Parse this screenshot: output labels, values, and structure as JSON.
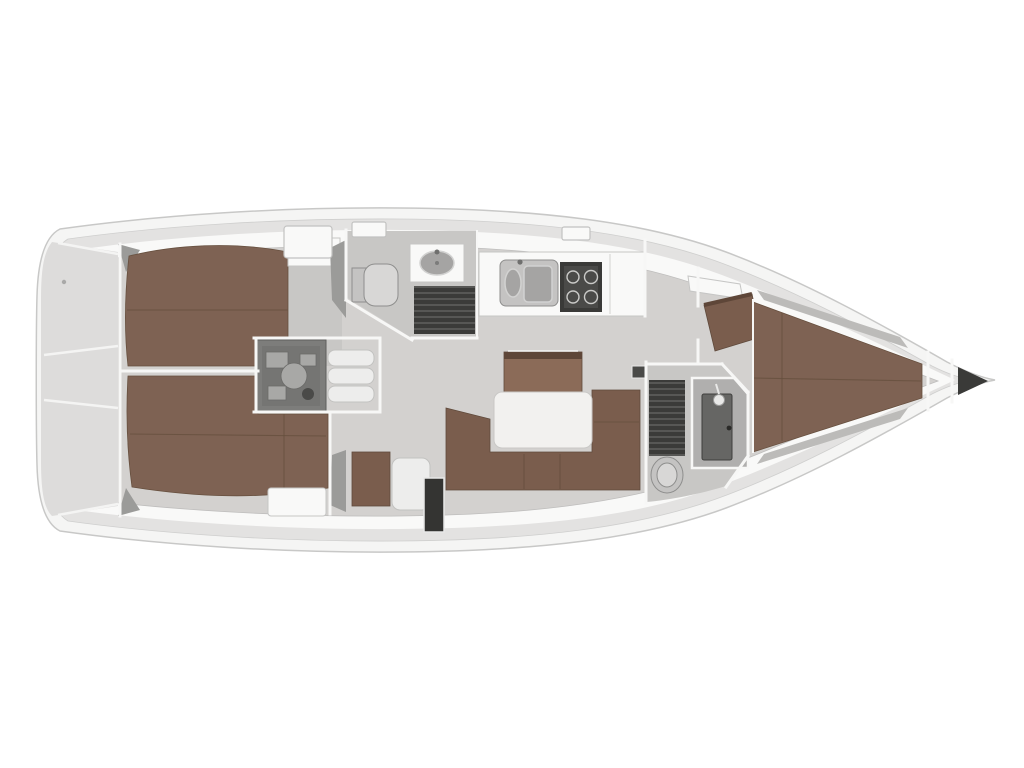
{
  "image": {
    "kind": "sailing-yacht-interior-floor-plan",
    "view": "top-down",
    "orientation": "bow-right-stern-left",
    "visible_text": ""
  },
  "colors": {
    "background": "#ffffff",
    "hull_white": "#f5f5f4",
    "hull_stroke": "#c8c8c7",
    "lining_gray": "#e3e2e1",
    "deck_white": "#f9f9f8",
    "floor_gray": "#d3d1cf",
    "room_floor": "#c8c7c5",
    "wall_white": "#f7f7f6",
    "berth_brown": "#7e6253",
    "berth_seam": "#67503f",
    "sofa_brown": "#7a5d4d",
    "sideboard_brown": "#8b6b58",
    "table_white": "#f2f1ef",
    "fixture_gray": "#c4c3c2",
    "fixture_stroke": "#8e8e8d",
    "grating_dark": "#3b3b39",
    "grating_line": "#575755",
    "appliance_dark": "#3a3a38",
    "engine_gray": "#7d7d7b",
    "locker_dark": "#343432"
  },
  "regions": [
    "stern-transom-lockers",
    "aft-cabin-starboard",
    "aft-cabin-port",
    "engine-compartment",
    "companionway-steps",
    "aft-head",
    "galley",
    "salon",
    "forward-head",
    "forward-cabin",
    "bow-anchor-locker"
  ],
  "fixtures": [
    "double-berth-starboard",
    "double-berth-port",
    "v-berth",
    "toilet-aft",
    "toilet-forward",
    "washbasin-aft-head",
    "shower-grating-aft",
    "shower-grating-forward",
    "shower-stall",
    "double-galley-sink",
    "stove",
    "u-settee",
    "dining-table",
    "sideboard",
    "engine",
    "companionway-steps",
    "nav-seat",
    "wet-locker",
    "deck-hatches"
  ]
}
